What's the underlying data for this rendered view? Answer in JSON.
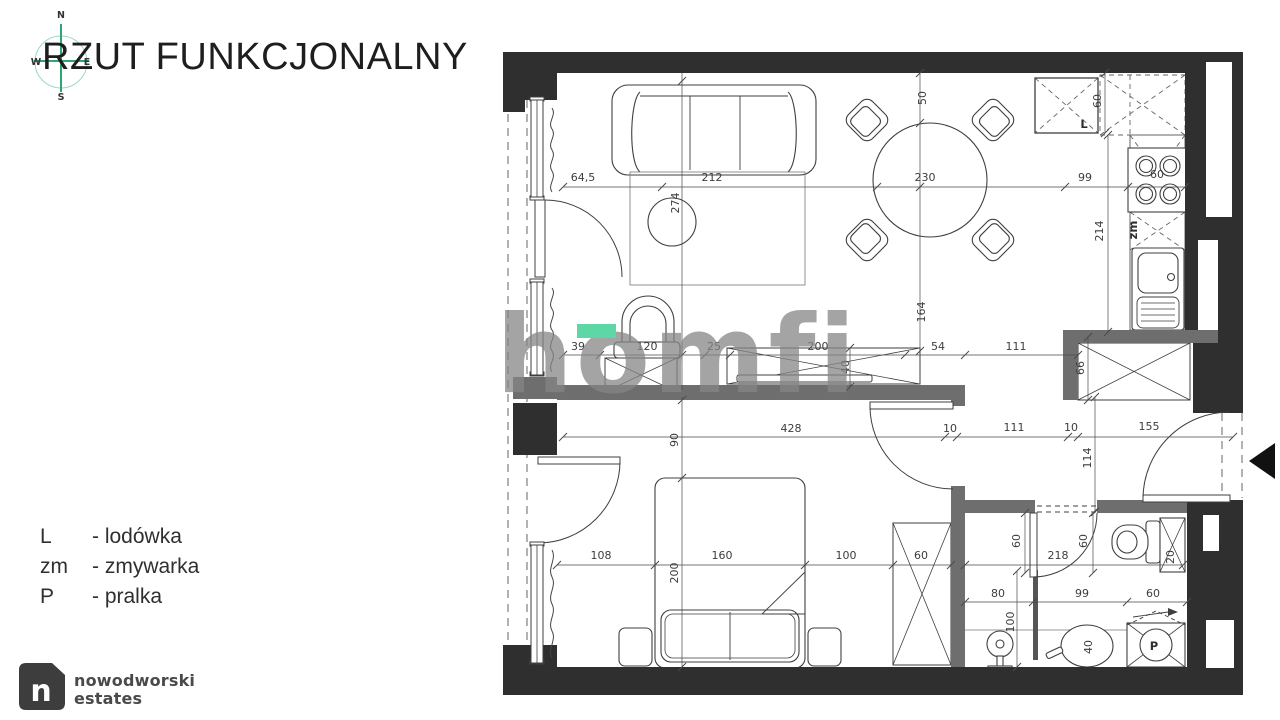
{
  "title": "RZUT FUNKCJONALNY",
  "compass": {
    "n": "N",
    "e": "E",
    "s": "S",
    "w": "W"
  },
  "legend": {
    "items": [
      {
        "abbr": "L",
        "name": "- lodówka"
      },
      {
        "abbr": "zm",
        "name": "- zmywarka"
      },
      {
        "abbr": "P",
        "name": "- pralka"
      }
    ]
  },
  "watermark": {
    "text": "homfi"
  },
  "brand": {
    "mark": "n",
    "line1": "nowodworski",
    "line2": "estates"
  },
  "colors": {
    "wall": "#2f2f2f",
    "partition": "#6e6e6e",
    "accent_green": "#5ed7a7",
    "compass_green": "#2ea673"
  },
  "plan": {
    "appliances": [
      {
        "t": "L",
        "x": 1084,
        "y": 128
      },
      {
        "t": "zm",
        "x": 1137,
        "y": 230,
        "r": 1
      },
      {
        "t": "P",
        "x": 1154,
        "y": 650
      }
    ],
    "dimensions": [
      {
        "t": "64,5",
        "x": 583,
        "y": 181
      },
      {
        "t": "212",
        "x": 712,
        "y": 181
      },
      {
        "t": "230",
        "x": 925,
        "y": 181
      },
      {
        "t": "99",
        "x": 1085,
        "y": 181
      },
      {
        "t": "60",
        "x": 1157,
        "y": 178
      },
      {
        "t": "50",
        "x": 926,
        "y": 98,
        "r": 1
      },
      {
        "t": "274",
        "x": 679,
        "y": 203,
        "r": 1
      },
      {
        "t": "164",
        "x": 925,
        "y": 312,
        "r": 1
      },
      {
        "t": "60",
        "x": 1101,
        "y": 101,
        "r": 1
      },
      {
        "t": "214",
        "x": 1103,
        "y": 231,
        "r": 1
      },
      {
        "t": "39",
        "x": 578,
        "y": 350
      },
      {
        "t": "120",
        "x": 647,
        "y": 350
      },
      {
        "t": "25",
        "x": 714,
        "y": 350
      },
      {
        "t": "200",
        "x": 818,
        "y": 350
      },
      {
        "t": "54",
        "x": 938,
        "y": 350
      },
      {
        "t": "111",
        "x": 1016,
        "y": 350
      },
      {
        "t": "40",
        "x": 849,
        "y": 367,
        "r": 1
      },
      {
        "t": "66",
        "x": 1084,
        "y": 368,
        "r": 1
      },
      {
        "t": "428",
        "x": 791,
        "y": 432
      },
      {
        "t": "10",
        "x": 950,
        "y": 432
      },
      {
        "t": "111",
        "x": 1014,
        "y": 431
      },
      {
        "t": "10",
        "x": 1071,
        "y": 431
      },
      {
        "t": "155",
        "x": 1149,
        "y": 430
      },
      {
        "t": "114",
        "x": 1091,
        "y": 458,
        "r": 1
      },
      {
        "t": "90",
        "x": 678,
        "y": 440,
        "r": 1
      },
      {
        "t": "200",
        "x": 678,
        "y": 573,
        "r": 1
      },
      {
        "t": "108",
        "x": 601,
        "y": 559
      },
      {
        "t": "160",
        "x": 722,
        "y": 559
      },
      {
        "t": "100",
        "x": 846,
        "y": 559
      },
      {
        "t": "60",
        "x": 921,
        "y": 559
      },
      {
        "t": "60",
        "x": 1020,
        "y": 541,
        "r": 1
      },
      {
        "t": "60",
        "x": 1087,
        "y": 541,
        "r": 1
      },
      {
        "t": "218",
        "x": 1058,
        "y": 559
      },
      {
        "t": "20",
        "x": 1174,
        "y": 557,
        "r": 1
      },
      {
        "t": "80",
        "x": 998,
        "y": 597
      },
      {
        "t": "99",
        "x": 1082,
        "y": 597
      },
      {
        "t": "60",
        "x": 1153,
        "y": 597
      },
      {
        "t": "100",
        "x": 1014,
        "y": 622,
        "r": 1
      },
      {
        "t": "40",
        "x": 1092,
        "y": 647,
        "r": 1
      }
    ]
  }
}
